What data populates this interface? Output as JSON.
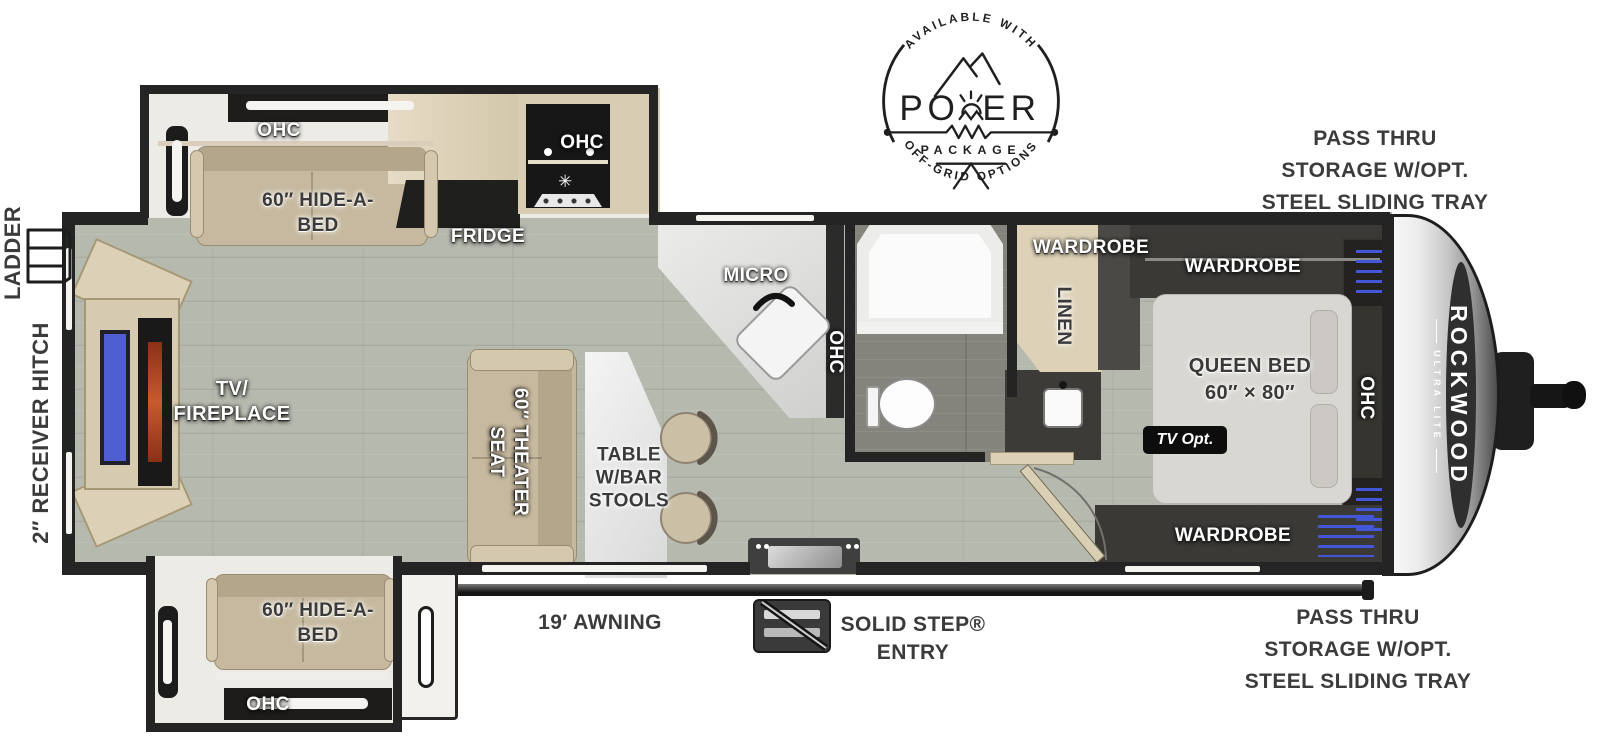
{
  "badge": {
    "top_arc": "AVAILABLE WITH",
    "word": "POWER",
    "word_left": "PO",
    "word_right": "ER",
    "package": "PACKAGE",
    "bottom_arc": "OFF-GRID OPTIONS"
  },
  "exterior": {
    "ladder": "LADDER",
    "receiver_hitch": "2″ RECEIVER HITCH",
    "pass_thru_top": {
      "l1": "PASS THRU",
      "l2": "STORAGE W/OPT.",
      "l3": "STEEL SLIDING TRAY"
    },
    "pass_thru_bottom": {
      "l1": "PASS THRU",
      "l2": "STORAGE W/OPT.",
      "l3": "STEEL SLIDING TRAY"
    },
    "awning": "19′ AWNING",
    "entry": {
      "l1": "SOLID STEP®",
      "l2": "ENTRY"
    }
  },
  "slide_top": {
    "ohc": "OHC",
    "bed_l1": "60″ HIDE-A-",
    "bed_l2": "BED"
  },
  "slide_bottom": {
    "ohc": "OHC",
    "bed_l1": "60″ HIDE-A-",
    "bed_l2": "BED"
  },
  "kitchen": {
    "fridge": "FRIDGE",
    "ohc": "OHC",
    "micro": "MICRO",
    "sink_ohc": "OHC",
    "burner_icon": "✳"
  },
  "living": {
    "tv_fireplace_l1": "TV/",
    "tv_fireplace_l2": "FIREPLACE",
    "theater_l1": "60″ THEATER",
    "theater_l2": "SEAT",
    "table_l1": "TABLE",
    "table_l2": "W/BAR",
    "table_l3": "STOOLS"
  },
  "bath": {
    "wardrobe": "WARDROBE",
    "linen": "LINEN"
  },
  "bedroom": {
    "wardrobe_top": "WARDROBE",
    "wardrobe_bottom": "WARDROBE",
    "queen_l1": "QUEEN BED",
    "queen_l2": "60″ × 80″",
    "tv_opt": "TV Opt.",
    "ohc": "OHC"
  },
  "brand": {
    "name": "ROCKWOOD",
    "series": "ULTRA LITE"
  },
  "colors": {
    "wall": "#242424",
    "floor": "#b6b9ae",
    "bath_floor": "#84837c",
    "cabinet": "#dcd1b6",
    "sofa": "#c6b99f",
    "bed": "#d9d7d2",
    "tv_screen": "#4f5ed0",
    "fireplace_glow": "#b34a26",
    "wardrobe_accent": "#4456d8",
    "label_white": "#ffffff",
    "label_dark": "#3a3a3a"
  }
}
